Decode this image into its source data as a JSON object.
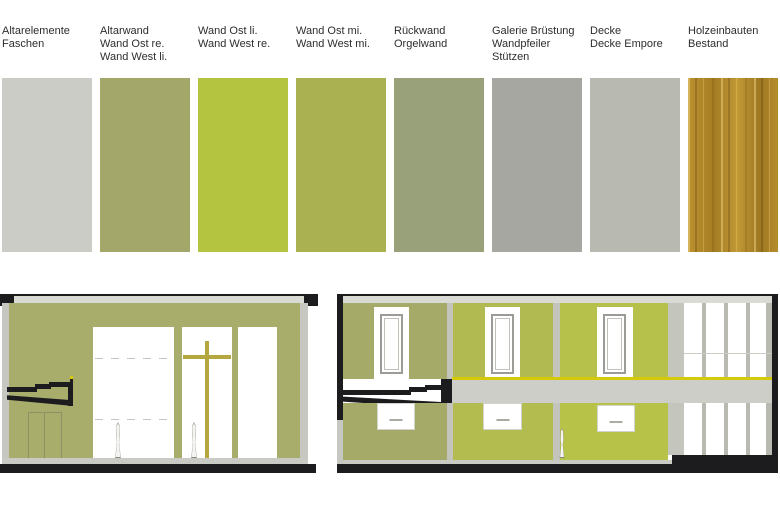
{
  "palette": {
    "swatches": [
      {
        "id": "altarelemente",
        "label": "Altarelemente\nFaschen",
        "color": "#cbccc6"
      },
      {
        "id": "altarwand",
        "label": "Altarwand\nWand Ost re.\nWand West li.",
        "color": "#a3a86a"
      },
      {
        "id": "wand-ost-li",
        "label": "Wand Ost li.\nWand West re.",
        "color": "#b5c440"
      },
      {
        "id": "wand-ost-mi",
        "label": "Wand Ost mi.\nWand West mi.",
        "color": "#a9b150"
      },
      {
        "id": "rueckwand",
        "label": "Rückwand\nOrgelwand",
        "color": "#99a17b"
      },
      {
        "id": "galerie",
        "label": "Galerie Brüstung\nWandpfeiler\nStützen",
        "color": "#a7a7a1"
      },
      {
        "id": "decke",
        "label": "Decke\nDecke Empore",
        "color": "#b8bab2"
      },
      {
        "id": "holzeinbauten",
        "label": "Holzeinbauten\nBestand",
        "color": "#b28a2b",
        "texture": "wood"
      }
    ]
  },
  "drawings": {
    "colors": {
      "wall_olive": "#a9ad6c",
      "wall_olive_right": "#a6aa69",
      "green_mid": "#b0ba51",
      "green_bright": "#b5c14a",
      "green_mid_low": "#b3bd4f",
      "green_bright_low": "#b7c348",
      "ceiling": "#d9dad4",
      "edge_gray": "#c6c7c0",
      "divider_gray": "#c3c4bc",
      "column_gray": "#c4c5bd",
      "slab_gray": "#cdcec7",
      "floor_strip": "#c9cac3",
      "transom": "#cdcec6",
      "mullion": "#b8b9b1",
      "black": "#1c1c1e",
      "cross_gold": "#b3a73d",
      "rail_yellow": "#d5c90a",
      "figure_outline": "#85867e",
      "white": "#ffffff"
    }
  }
}
